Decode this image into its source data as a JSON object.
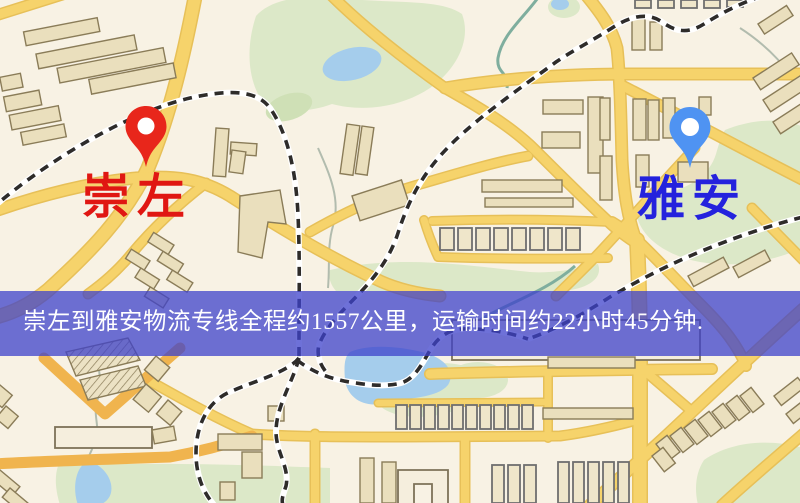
{
  "banner": {
    "text": "崇左到雅安物流专线全程约1557公里，运输时间约22小时45分钟."
  },
  "markers": {
    "origin": {
      "label": "崇左",
      "icon": "map-pin"
    },
    "destination": {
      "label": "雅安",
      "icon": "map-pin"
    }
  },
  "colors": {
    "map_bg": "#f8f2e4",
    "road_yellow": "#f6d36b",
    "road_orange": "#f0b44e",
    "building": "#eadfbd",
    "park": "#dce8c8",
    "water": "#a5cdec",
    "railway": "#2e2c2a",
    "banner_bg": "rgba(62,66,203,0.75)",
    "banner_text": "#ffffff",
    "origin_pin": "#e8261b",
    "origin_label": "#e01712",
    "destination_pin": "#4f93f2",
    "destination_label": "#2422dd"
  }
}
